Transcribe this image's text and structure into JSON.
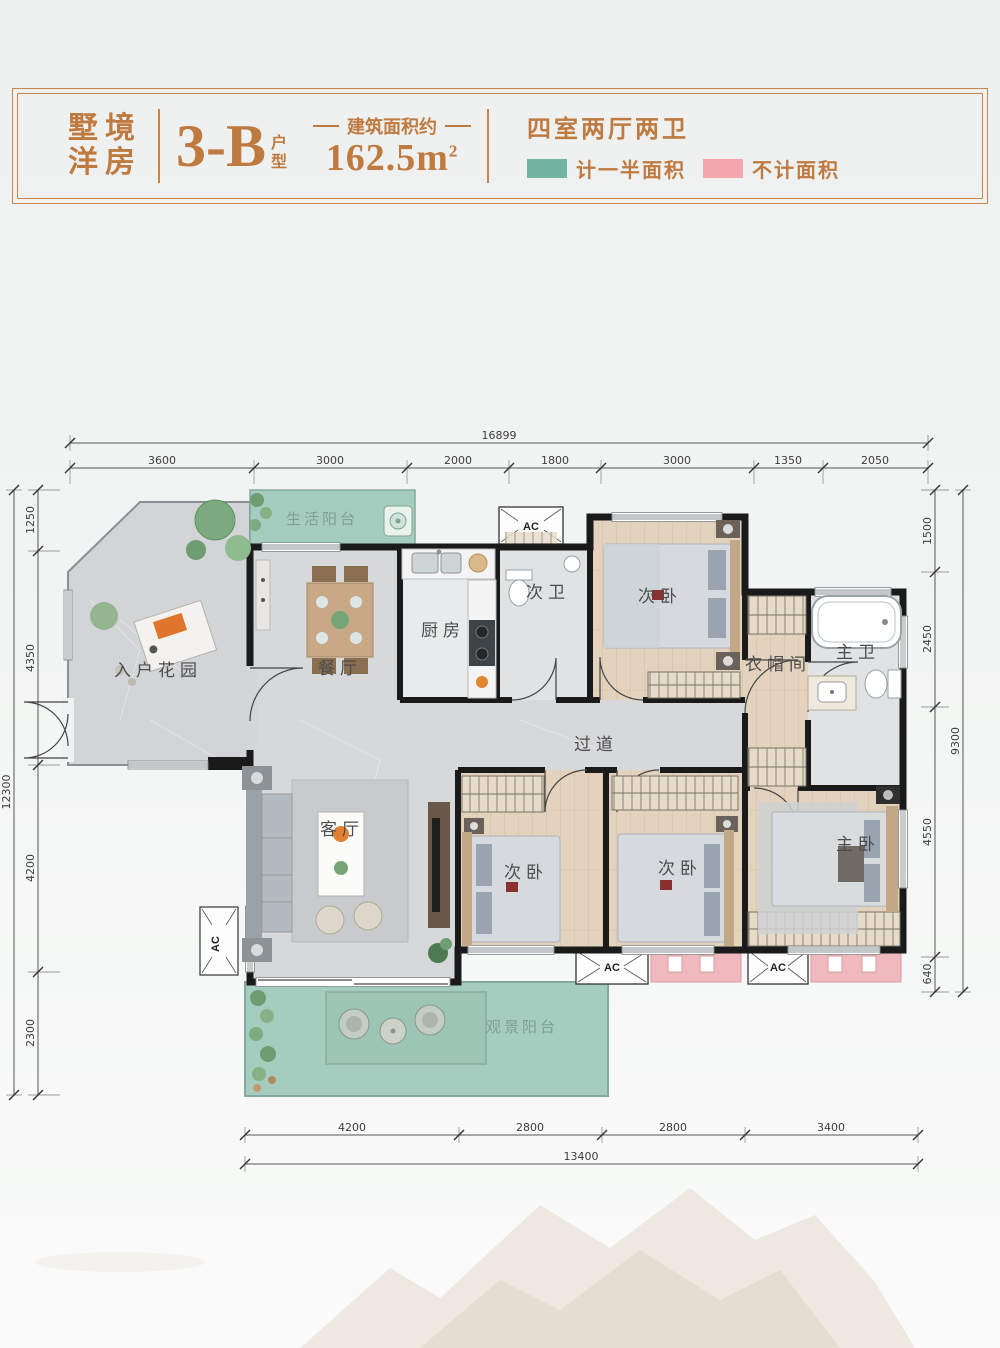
{
  "header": {
    "series_line1": "墅境",
    "series_line2": "洋房",
    "unit_code": "3-B",
    "unit_suffix_line1": "户",
    "unit_suffix_line2": "型",
    "area_caption": "建筑面积约",
    "area_value": "162.5",
    "area_unit": "m",
    "area_sup": "2",
    "layout_text": "四室两厅两卫",
    "legend": [
      {
        "label": "计一半面积",
        "color": "#72b3a1"
      },
      {
        "label": "不计面积",
        "color": "#f3a6ae"
      }
    ],
    "accent_color": "#bf7a40",
    "border_color": "#c9854e"
  },
  "plan": {
    "ac_label": "AC",
    "rooms": {
      "life_balcony": "生活阳台",
      "entry_garden": "入户花园",
      "dining": "餐厅",
      "kitchen": "厨房",
      "second_bath": "次卫",
      "bedroom_top": "次卧",
      "cloakroom": "衣帽间",
      "master_bath": "主卫",
      "corridor": "过道",
      "living": "客厅",
      "bedroom_left": "次卧",
      "bedroom_mid": "次卧",
      "master_bedroom": "主卧",
      "view_balcony": "观景阳台"
    },
    "colors": {
      "wall": "#1a1a1a",
      "balcony": "#a5cdbf",
      "uncounted_pink": "#f0b9be",
      "wood_floor": "#e3d2bd",
      "marble_floor": "#d7d8da",
      "tile_floor": "#e9eaeb"
    }
  },
  "dimensions": {
    "top": {
      "total": "16899",
      "segments": [
        "3600",
        "3000",
        "2000",
        "1800",
        "3000",
        "1350",
        "2050"
      ]
    },
    "left": {
      "total": "12300",
      "segments": [
        "1250",
        "4350",
        "4200",
        "2300"
      ]
    },
    "right": {
      "total": "9300",
      "segments": [
        "1500",
        "2450",
        "4550",
        "640"
      ]
    },
    "bottom": {
      "total": "13400",
      "segments": [
        "4200",
        "2800",
        "2800",
        "3400"
      ]
    }
  }
}
